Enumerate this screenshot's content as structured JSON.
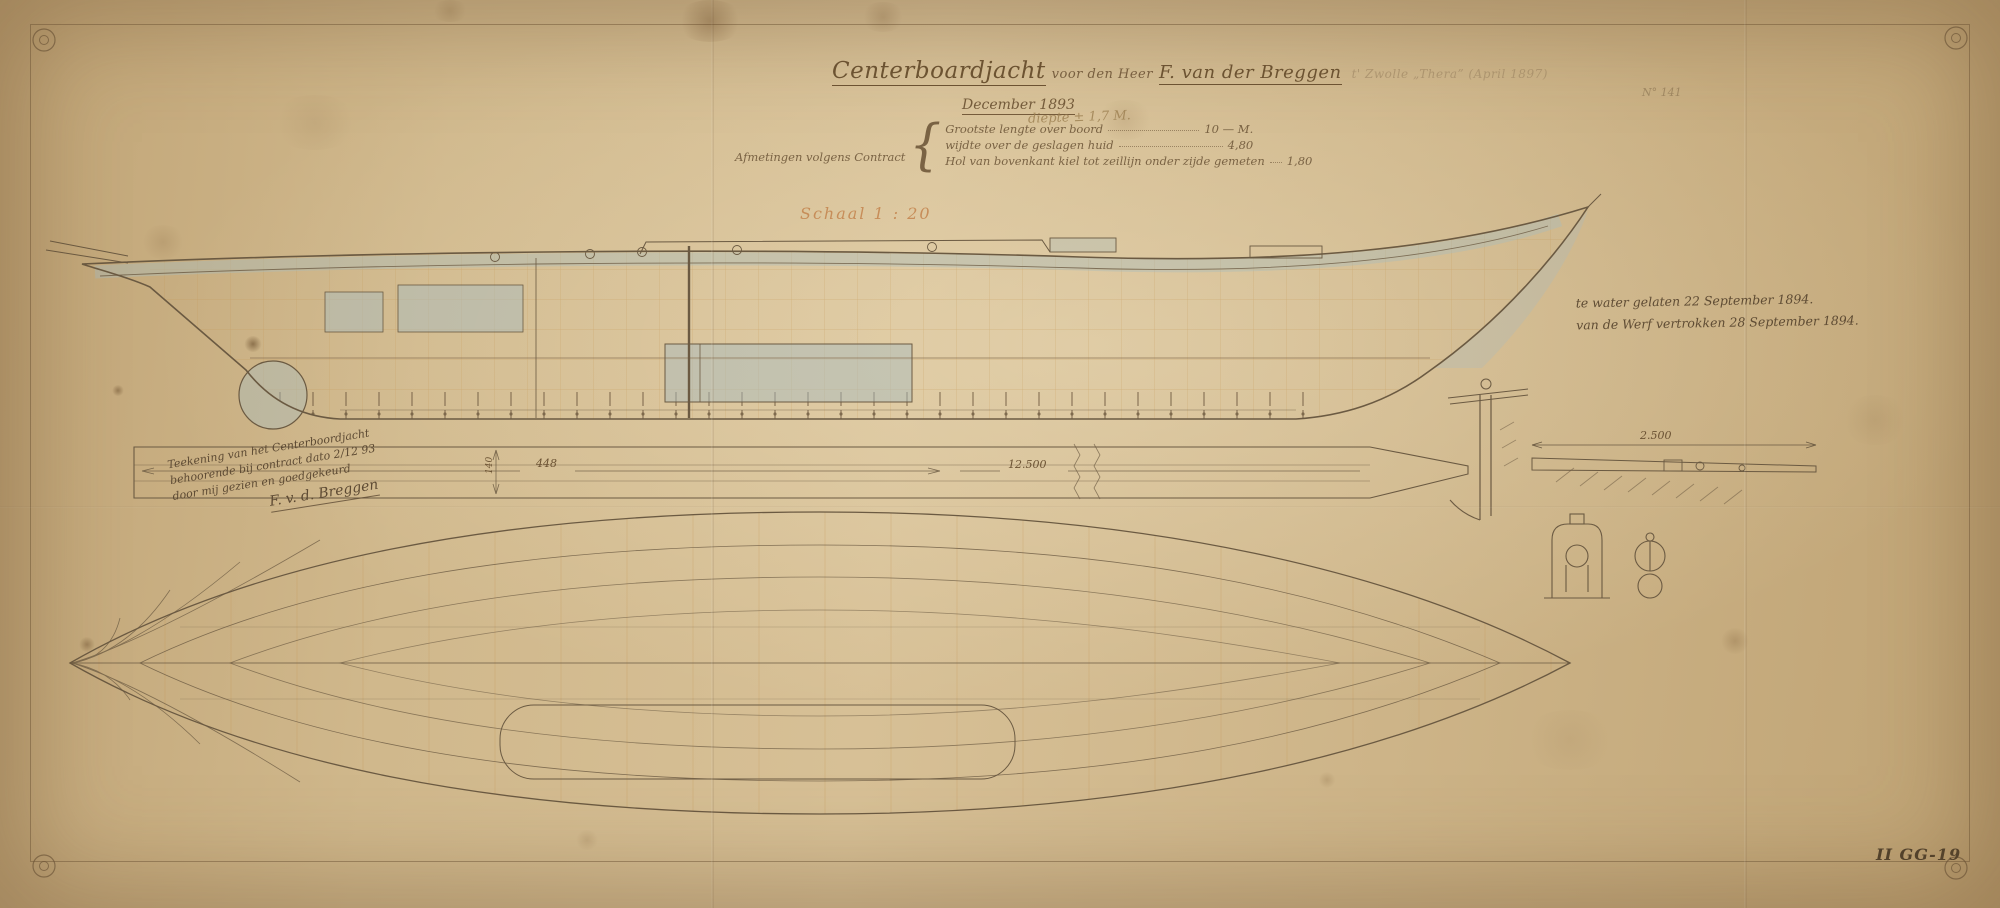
{
  "colors": {
    "ink": "#6b5a42",
    "grid": "#c4934f",
    "wash": "#aabcbd",
    "scale_red": "#c07a42",
    "paper": "#d2ba8f"
  },
  "title_block": {
    "title_main": "Centerboardjacht",
    "title_connector": "voor den Heer",
    "title_name": "F. van der Breggen",
    "title_faint": "t' Zwolle  „Thera”  (April 1897)",
    "date_line": "December 1893",
    "pencil_note": "diepte ± 1,7 M.",
    "dimensions_caption": "Afmetingen volgens Contract",
    "brace": "{",
    "dimensions": [
      {
        "label": "Grootste lengte over boord",
        "value": "10 — M."
      },
      {
        "label": "wijdte over de geslagen huid",
        "value": "4,80"
      },
      {
        "label": "Hol van bovenkant kiel tot zeillijn onder zijde gemeten",
        "value": "1,80"
      }
    ],
    "scale_note": "Schaal 1 : 20"
  },
  "notes": {
    "launch_line1": "te water gelaten 22 September 1894.",
    "launch_line2": "van de Werf vertrokken 28 September 1894.",
    "approval_line1": "Teekening van het Centerboordjacht",
    "approval_line2": "behoorende bij contract dato 2/12 93",
    "approval_line3": "door mij gezien en goedgekeurd",
    "approval_signature": "F. v. d. Breggen",
    "sheet_number": "N° 141",
    "archive_mark": "II GG-19"
  },
  "measurements": {
    "strip_length": "448",
    "strip_height": "140",
    "strip_total": "12.500",
    "spar_length": "2.500"
  }
}
